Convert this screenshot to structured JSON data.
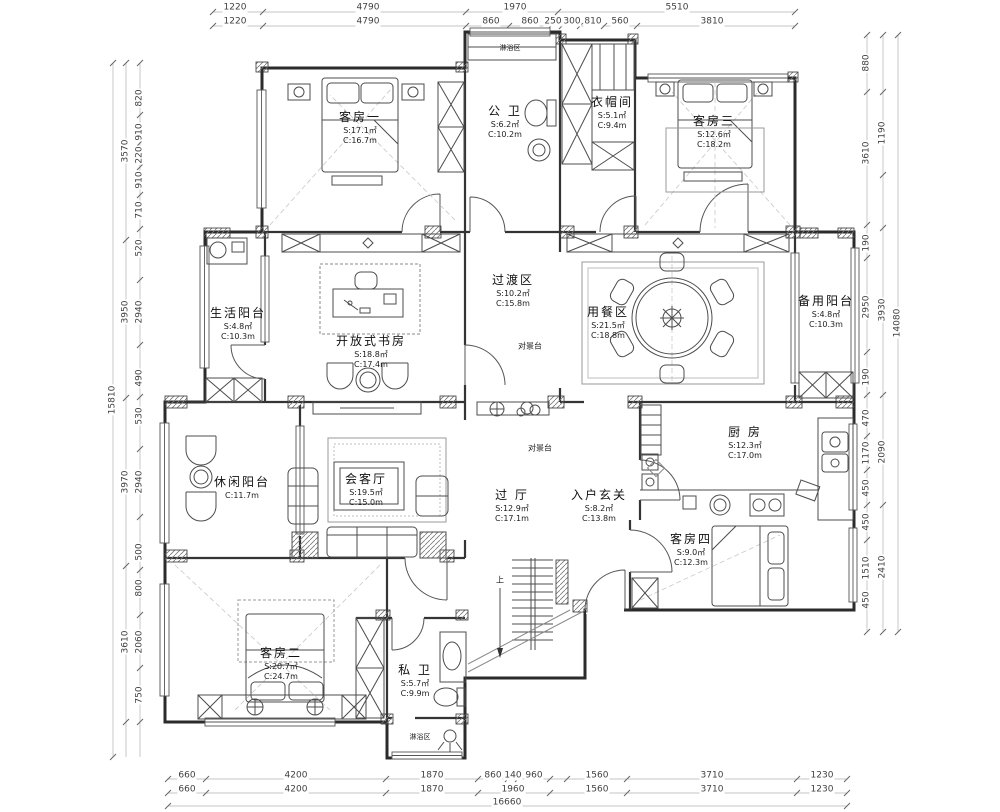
{
  "rooms": {
    "guest1": {
      "name": "客房一",
      "s": "S:17.1㎡",
      "c": "C:16.7m"
    },
    "public_bath": {
      "name": "公 卫",
      "s": "S:6.2㎡",
      "c": "C:10.2m"
    },
    "cloak": {
      "name": "衣帽间",
      "s": "S:5.1㎡",
      "c": "C:9.4m"
    },
    "guest3": {
      "name": "客房三",
      "s": "S:12.6㎡",
      "c": "C:18.2m"
    },
    "life_balcony": {
      "name": "生活阳台",
      "s": "S:4.8㎡",
      "c": "C:10.3m"
    },
    "study": {
      "name": "开放式书房",
      "s": "S:18.8㎡",
      "c": "C:17.4m"
    },
    "transition": {
      "name": "过渡区",
      "s": "S:10.2㎡",
      "c": "C:15.8m"
    },
    "dining": {
      "name": "用餐区",
      "s": "S:21.5㎡",
      "c": "C:18.8m"
    },
    "spare_balcony": {
      "name": "备用阳台",
      "s": "S:4.8㎡",
      "c": "C:10.3m"
    },
    "leisure_balcony": {
      "name": "休闲阳台",
      "s": "S:7.9㎡",
      "c": "C:11.7m"
    },
    "reception": {
      "name": "会客厅",
      "s": "S:19.5㎡",
      "c": "C:15.0m"
    },
    "hall": {
      "name": "过 厅",
      "s": "S:12.9㎡",
      "c": "C:17.1m"
    },
    "foyer": {
      "name": "入户玄关",
      "s": "S:8.2㎡",
      "c": "C:13.8m"
    },
    "kitchen": {
      "name": "厨 房",
      "s": "S:12.3㎡",
      "c": "C:17.0m"
    },
    "guest4": {
      "name": "客房四",
      "s": "S:9.0㎡",
      "c": "C:12.3m"
    },
    "guest2": {
      "name": "客房二",
      "s": "S:20.7㎡",
      "c": "C:24.7m"
    },
    "private_bath": {
      "name": "私 卫",
      "s": "S:5.7㎡",
      "c": "C:9.9m"
    }
  },
  "annotations": {
    "scenery1": "对景台",
    "scenery2": "对景台",
    "shower_top": "淋浴区",
    "shower_bottom": "淋浴区",
    "stairs_up": "上"
  },
  "dims": {
    "top_row1": [
      "1220",
      "4790",
      "1970",
      "5510"
    ],
    "top_row2": [
      "1220",
      "4790",
      "860",
      "860",
      "250",
      "300",
      "810",
      "560",
      "3810"
    ],
    "bottom_row1": [
      "660",
      "4200",
      "1870",
      "860",
      "140",
      "960",
      "1560",
      "3710",
      "1230"
    ],
    "bottom_row2": [
      "660",
      "4200",
      "1870",
      "1960",
      "1560",
      "3710",
      "1230"
    ],
    "bottom_total": "16660",
    "left_inner": [
      "820",
      "910",
      "220",
      "910",
      "710",
      "520",
      "2940",
      "490",
      "530",
      "2940",
      "500",
      "800",
      "2060",
      "750"
    ],
    "left_mid": [
      "3570",
      "3950",
      "3970",
      "3610"
    ],
    "left_total": "15810",
    "right_inner": [
      "880",
      "3610",
      "190",
      "2950",
      "190",
      "470",
      "1170",
      "450",
      "450",
      "1510",
      "450"
    ],
    "right_mid": [
      "1190",
      "3930",
      "2090",
      "2410"
    ],
    "right_total": "14080"
  },
  "colors": {
    "wall": "#2b2b2b",
    "line": "#555555",
    "dim": "#3f3f3f",
    "dash": "#c8c8c8"
  }
}
